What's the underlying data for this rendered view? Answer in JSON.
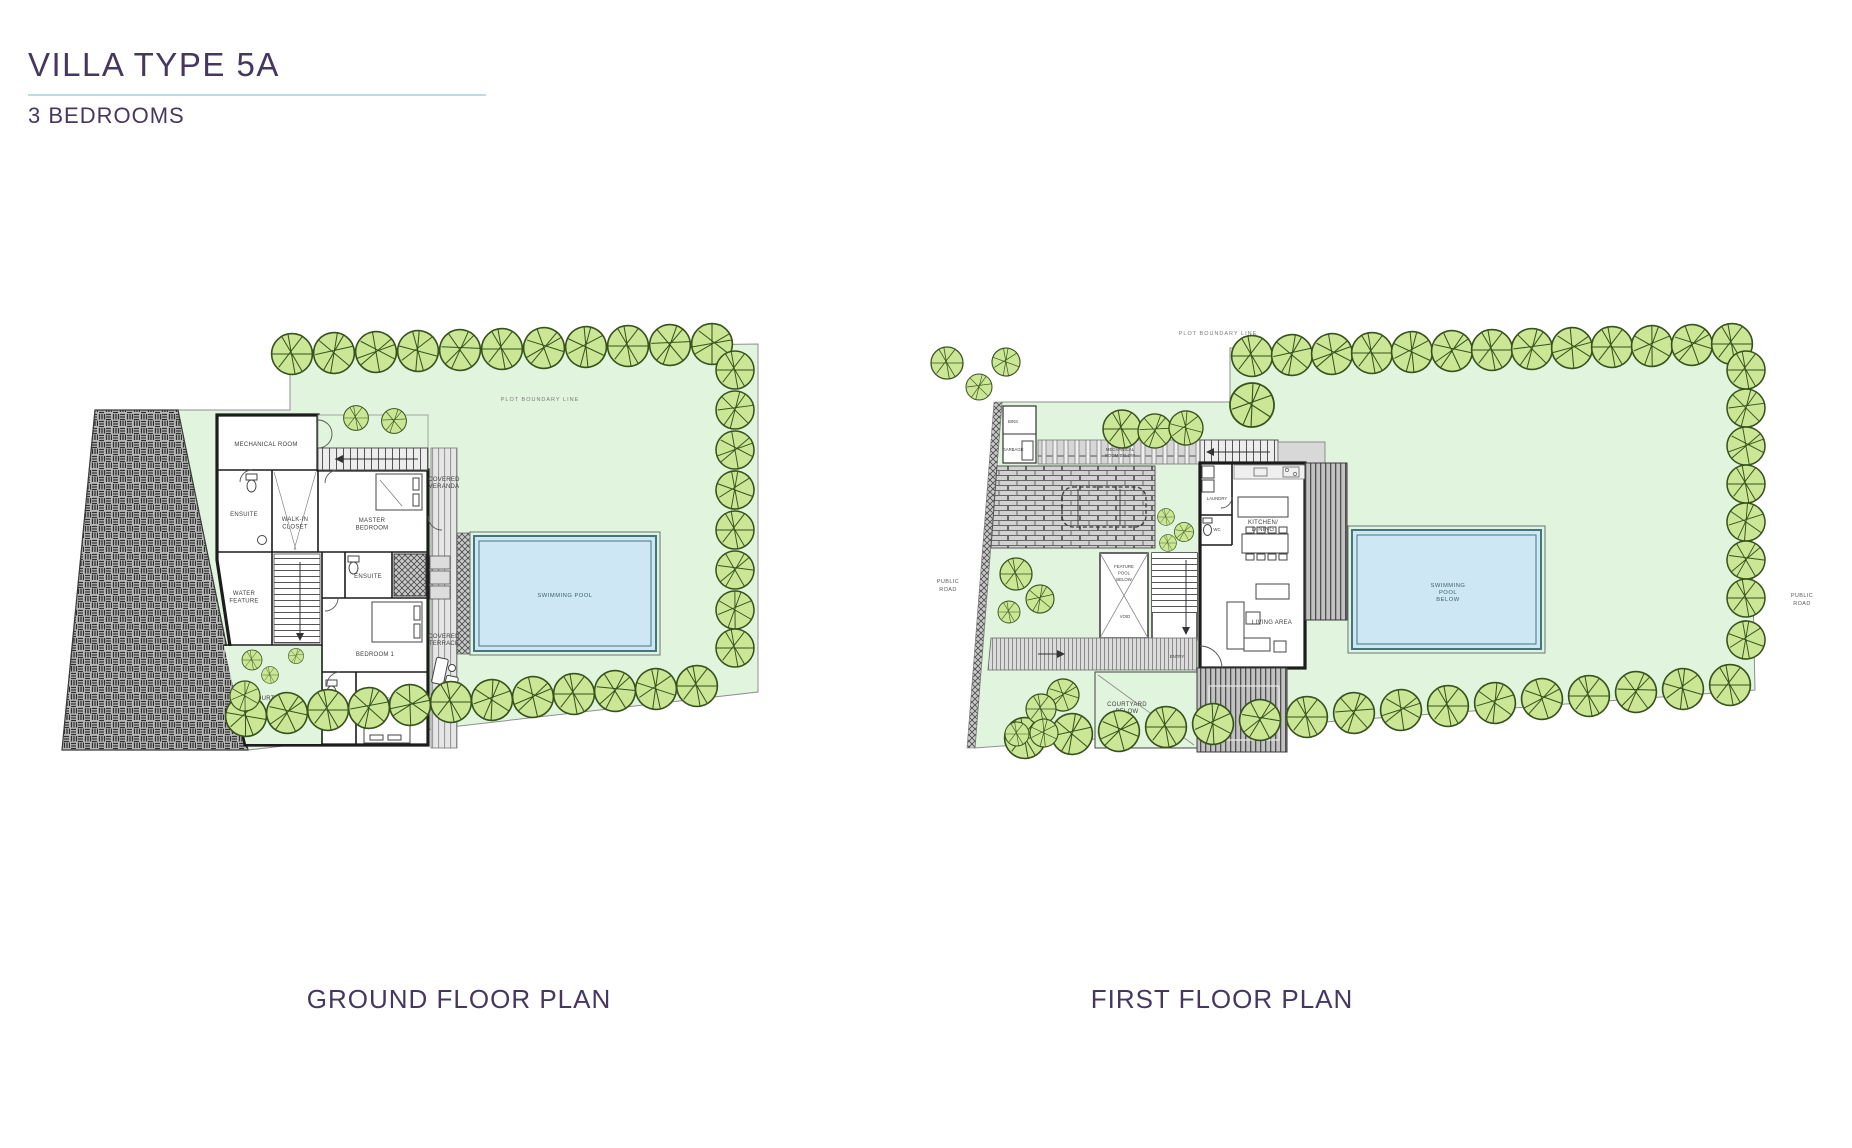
{
  "page": {
    "title": "VILLA TYPE 5A",
    "subtitle": "3 BEDROOMS"
  },
  "captions": {
    "ground_floor": "GROUND FLOOR PLAN",
    "first_floor": "FIRST FLOOR PLAN"
  },
  "colors": {
    "title_purple": "#463760",
    "accent_line": "#badde2",
    "lawn_green": "#e1f4dd",
    "tree_green": "#cbe795",
    "pool_blue": "#cde8f4",
    "pool_edge": "#46757e",
    "wall_black": "#1c1c1c",
    "label_grey": "#3f3f3f"
  },
  "ground_floor": {
    "plot_boundary_label": "PLOT BOUNDARY LINE",
    "rooms": {
      "mechanical_room": [
        "MECHANICAL ROOM"
      ],
      "ensuite_left": [
        "ENSUITE"
      ],
      "walk_in_closet": [
        "WALK-IN",
        "CLOSET"
      ],
      "master_bedroom": [
        "MASTER",
        "BEDROOM"
      ],
      "water_feature": [
        "WATER",
        "FEATURE"
      ],
      "ensuite_mid": [
        "ENSUITE"
      ],
      "bedroom_1": [
        "BEDROOM 1"
      ],
      "courtyard": [
        "COURTYARD"
      ],
      "ensuite_2": [
        "ENSUITE"
      ],
      "bedroom_2": [
        "BEDROOM 2"
      ],
      "covered_veranda": [
        "COVERED",
        "VERANDA"
      ],
      "covered_terrace": [
        "COVERED",
        "TERRACE"
      ],
      "swimming_pool": [
        "SWIMMING POOL"
      ]
    }
  },
  "first_floor": {
    "plot_boundary_label": "PLOT BOUNDARY LINE",
    "public_road_left": [
      "PUBLIC",
      "ROAD"
    ],
    "public_road_right": [
      "PUBLIC",
      "ROAD"
    ],
    "rooms": {
      "bins": [
        "BINS"
      ],
      "garbage": [
        "GARBAGE"
      ],
      "mechanical_room_below": [
        "MECHANICAL",
        "ROOM BELOW"
      ],
      "laundry": [
        "LAUNDRY"
      ],
      "wc": [
        "WC"
      ],
      "kitchen_dining": [
        "KITCHEN/",
        "DINING"
      ],
      "living_area": [
        "LIVING AREA"
      ],
      "feature_pool_below": [
        "FEATURE",
        "POOL",
        "BELOW"
      ],
      "void_feature_pool": [
        "VOID"
      ],
      "entry": [
        "ENTRY"
      ],
      "courtyard_below": [
        "COURTYARD",
        "BELOW"
      ],
      "void_courtyard": [
        "VOID"
      ],
      "swimming_pool_below": [
        "SWIMMING",
        "POOL",
        "BELOW"
      ]
    }
  }
}
